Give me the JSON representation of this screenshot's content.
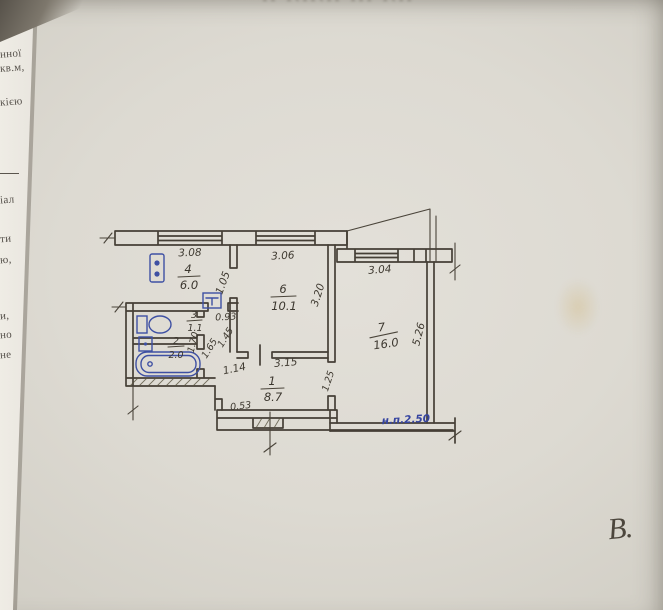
{
  "photo": {
    "stamp_text": "ıı ılıılıı ııı ılıı",
    "signature": "В.",
    "left_fragments": [
      {
        "text": ", 2-а"
      },
      {
        "text": "нної"
      },
      {
        "text": "кв.м,"
      },
      {
        "text": "кією"
      },
      {
        "text": "іал"
      },
      {
        "text": "ти"
      },
      {
        "text": "ю,"
      },
      {
        "text": "и,"
      },
      {
        "text": "но"
      },
      {
        "text": "не"
      }
    ]
  },
  "plan": {
    "rooms": [
      {
        "number": "4",
        "area": "6.0"
      },
      {
        "number": "6",
        "area": "10.1"
      },
      {
        "number": "7",
        "area": "16.0"
      },
      {
        "number": "3",
        "area": "1.1"
      },
      {
        "number": "2",
        "area": "2.0"
      },
      {
        "number": "1",
        "area": "8.7"
      }
    ],
    "dims": {
      "win_kitchen": "3.08",
      "win_living": "3.06",
      "win_bedroom": "3.04",
      "kitchen_side": "1.05",
      "living_side": "3.20",
      "bedroom_side": "5.26",
      "living_bottom": "3.15",
      "hall_top": "0.93",
      "hall_a": "1.45",
      "hall_b": "1.65",
      "hall_c": "1.70",
      "hall_entry": "1.14",
      "notch": "0.53",
      "door_bedroom": "1.25"
    },
    "height_note": "н.п.2.50",
    "colors": {
      "ink": "#453f36",
      "blue": "#3e50a3"
    }
  }
}
